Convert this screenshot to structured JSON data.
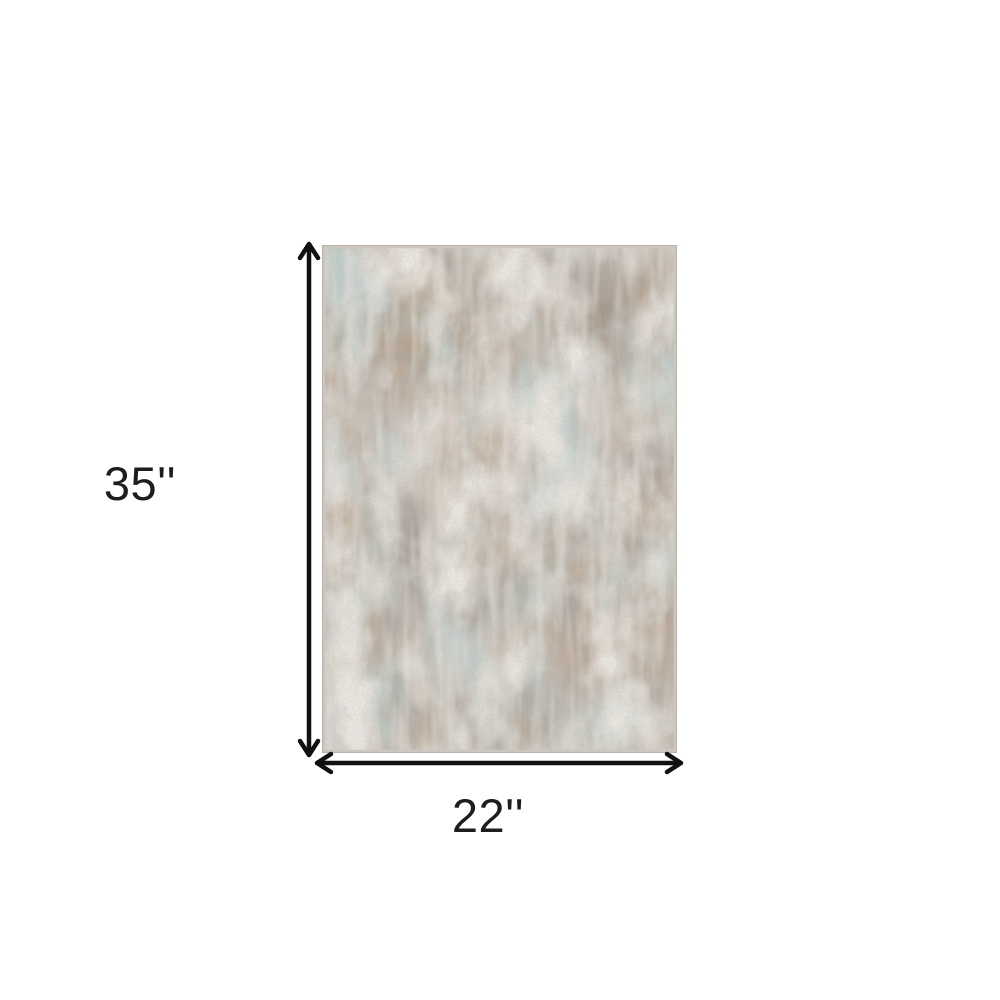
{
  "page": {
    "background_color": "#ffffff",
    "description": "Product dimension diagram of an abstract distressed area rug"
  },
  "rug": {
    "name": "abstract-distressed-area-rug",
    "colors": {
      "base": "#d3ccc2",
      "brown": "#7f644c",
      "taupe": "#6f645b",
      "teal": "#8ba19c",
      "cream": "#ded7cb",
      "edge": "#cbc7c0"
    }
  },
  "dimensions": {
    "height_label": "35''",
    "width_label": "22''",
    "arrow_color": "#111111",
    "label_color": "#1d1d1f"
  },
  "icons": {
    "up_arrowhead": "chevron-up",
    "down_arrowhead": "chevron-down",
    "left_arrowhead": "chevron-left",
    "right_arrowhead": "chevron-right"
  }
}
